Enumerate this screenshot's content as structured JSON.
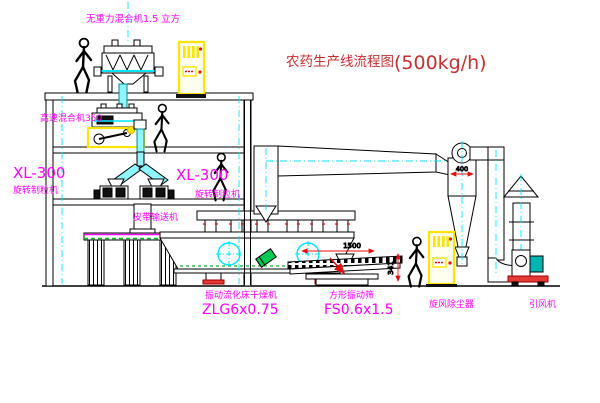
{
  "title": {
    "zh": "农药生产线流程图",
    "capacity": "(500kg/h)"
  },
  "labels": {
    "mixer_top": "无重力混合机1.5 立方",
    "mixer_mid": "高速混合机350",
    "granulator_left_model": "XL-300",
    "granulator_left_name": "旋转制粒机",
    "granulator_right_model": "XL-300",
    "granulator_right_name": "旋转制粒机",
    "belt_conveyor": "皮带输送机",
    "dryer_name": "振动流化床干燥机",
    "dryer_model": "ZLG6x0.75",
    "screen_name": "方形振动筛",
    "screen_model": "FS0.6x1.5",
    "cyclone": "旋风除尘器",
    "fan": "引风机"
  },
  "dimensions": {
    "cyclone_inlet": "400",
    "screen_length": "1500",
    "screen_height": "341"
  },
  "colors": {
    "line": "#000000",
    "centerline_cyan": "#00e5ff",
    "pipe_cyan": "#8ff5ff",
    "label_magenta": "#ff00ff",
    "title_red": "#c43030",
    "dimension_red": "#e01010",
    "cabinet_yellow": "#ffe400",
    "belt_green": "#00bb22",
    "motor_teal": "#00b3b3",
    "base_red": "#e53935",
    "cylinder_green": "#00c853"
  }
}
